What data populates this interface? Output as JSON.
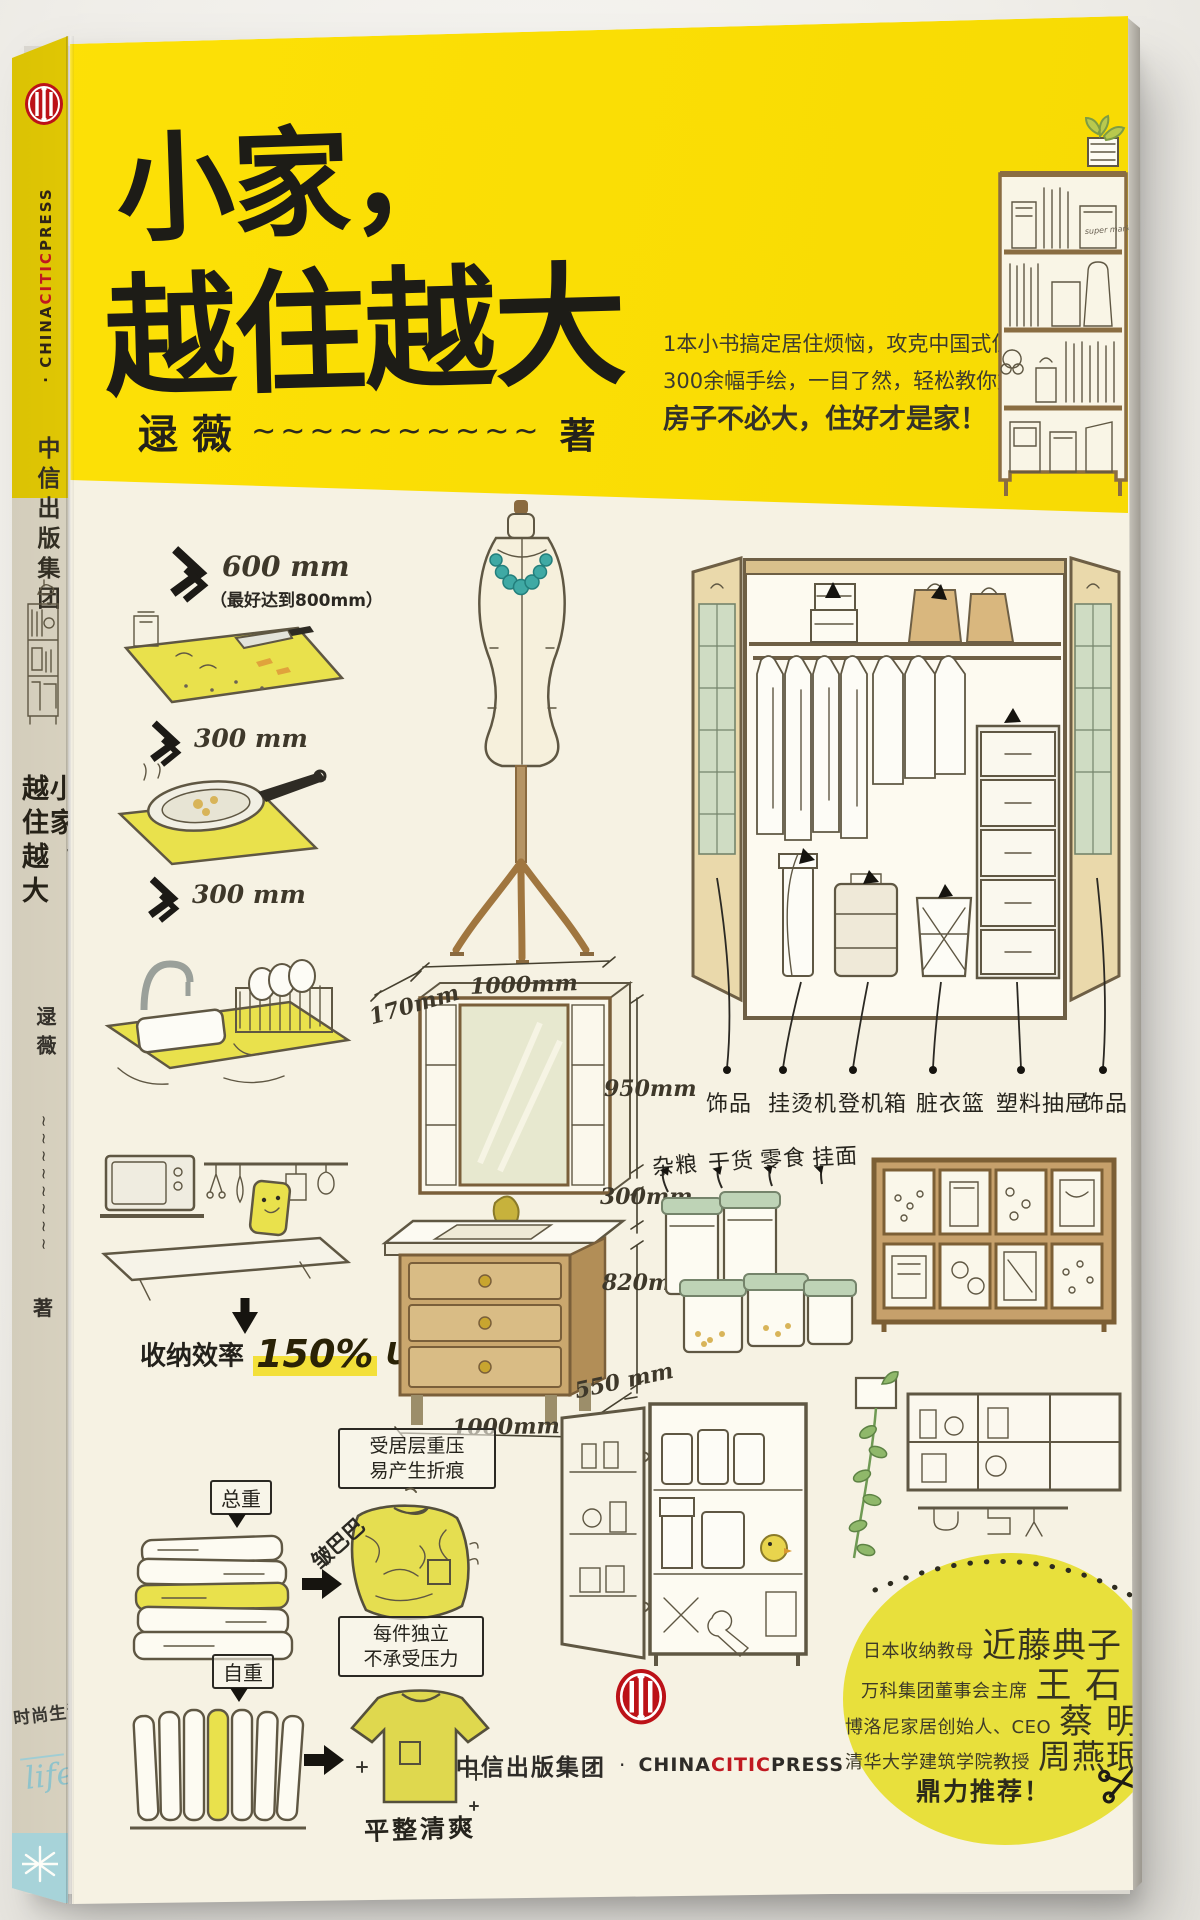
{
  "spine": {
    "publisher_en_pre": "· CHINA",
    "publisher_en_mid": "CITIC",
    "publisher_en_post": "PRESS",
    "publisher_cn": "中信出版集团",
    "title_right": "小家，",
    "title_left": "越住越大",
    "author": "逯薇",
    "tildes": "~~~~~~~~",
    "author_suffix": "著",
    "series_cn": "时尚生活",
    "series_en": "life"
  },
  "cover": {
    "title_line1": "小家，",
    "title_line2": "越住越大",
    "author": "逯薇",
    "tildes": "~~~~~~~~~~",
    "author_suffix": "著",
    "tagline1": "1本小书搞定居住烦恼，攻克中国式住宅收纳难题",
    "tagline2": "300余幅手绘，一目了然，轻松教你好好住",
    "tagline3": "房子不必大，住好才是家！",
    "bag_text": "super market"
  },
  "kitchen": {
    "dim1": "600 mm",
    "dim1_note": "（最好达到800mm）",
    "dim2": "300 mm",
    "dim3": "300 mm",
    "eff_label": "收纳效率",
    "eff_value": "150%",
    "eff_suffix": "UP!"
  },
  "vanity": {
    "w_top": "1000mm",
    "depth_top": "170mm",
    "h_mirror": "950mm",
    "h_gap": "300mm",
    "h_base": "820mm",
    "d_base": "550 mm",
    "w_base": "1000mm"
  },
  "wardrobe": {
    "hats": "帽子",
    "bags": "包包",
    "bottom": [
      "饰品",
      "挂烫机",
      "登机箱",
      "脏衣篮",
      "塑料抽屉",
      "饰品"
    ]
  },
  "pantry": [
    "杂粮",
    "干货",
    "零食",
    "挂面"
  ],
  "folding": {
    "total": "总重",
    "note1a": "受居层重压",
    "note1b": "易产生折痕",
    "wrinkled": "皱巴巴",
    "note2a": "每件独立",
    "note2b": "不承受压力",
    "self": "自重",
    "tidy": "平整清爽"
  },
  "recommend": {
    "rows": [
      {
        "title": "日本收纳教母",
        "name": "近藤典子"
      },
      {
        "title": "万科集团董事会主席",
        "name": "王 石"
      },
      {
        "title": "博洛尼家居创始人、CEO",
        "name": "蔡 明"
      },
      {
        "title": "清华大学建筑学院教授",
        "name": "周燕珉"
      }
    ],
    "footer": "鼎力推荐！"
  },
  "imprint": {
    "cn": "中信出版集团",
    "sep": "·",
    "en_pre": "CHINA",
    "en_mid": "CITIC",
    "en_post": "PRESS"
  }
}
